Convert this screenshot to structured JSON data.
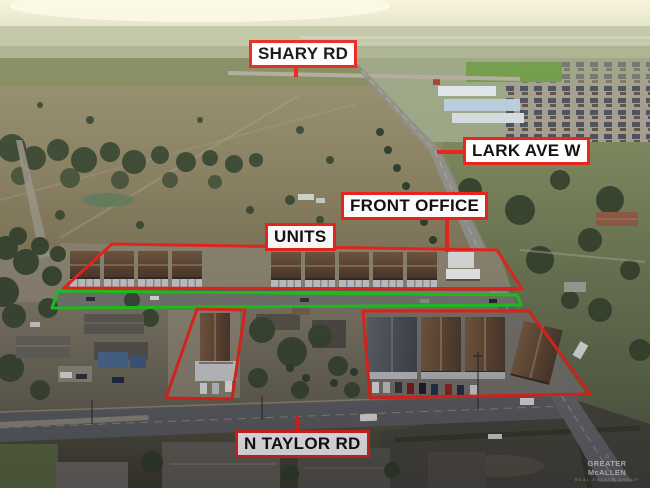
{
  "scene": {
    "description": "Aerial drone photograph at dusk of a rental-unit property between Shary Rd and N Taylor Rd, with red and green marked outlines"
  },
  "annotations": {
    "labels": {
      "shary_rd": "SHARY RD",
      "lark_ave_w": "LARK AVE W",
      "front_office": "FRONT OFFICE",
      "units": "UNITS",
      "n_taylor_rd": "N TAYLOR RD"
    },
    "colors": {
      "outline_red": "#e8251d",
      "outline_green": "#1dc91d",
      "label_background": "#ffffff",
      "label_border": "#e8251d",
      "label_text": "#111111"
    },
    "outlined_regions": [
      {
        "name": "units-strip",
        "color": "red",
        "label": "UNITS"
      },
      {
        "name": "driveway-strip",
        "color": "green"
      },
      {
        "name": "south-building-left",
        "color": "red"
      },
      {
        "name": "south-complex-right",
        "color": "red"
      }
    ]
  },
  "watermark": {
    "line1": "GREATER McALLEN",
    "line2": "REAL ESTATE GROUP"
  }
}
